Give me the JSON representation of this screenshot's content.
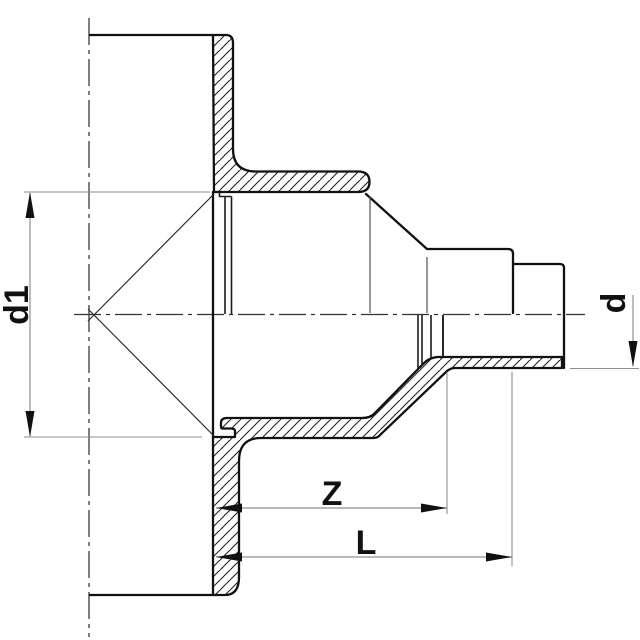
{
  "drawing": {
    "type": "technical-cross-section",
    "subject": "pipe reducer fitting, sectioned side view",
    "labels": {
      "d1": "d1",
      "d": "d",
      "z": "Z",
      "l": "L"
    },
    "dimensions": [
      {
        "name": "d1",
        "meaning": "large end bore diameter",
        "orientation": "vertical-left"
      },
      {
        "name": "d",
        "meaning": "small end diameter",
        "orientation": "vertical-right"
      },
      {
        "name": "Z",
        "meaning": "intermediate length from large end face",
        "orientation": "horizontal-bottom"
      },
      {
        "name": "L",
        "meaning": "overall length from large end face",
        "orientation": "horizontal-bottom"
      }
    ],
    "colors": {
      "background": "#ffffff",
      "outline": "#111111",
      "dimension_lines": "#8f8f8f",
      "centerline": "#333333",
      "text": "#111111"
    }
  }
}
